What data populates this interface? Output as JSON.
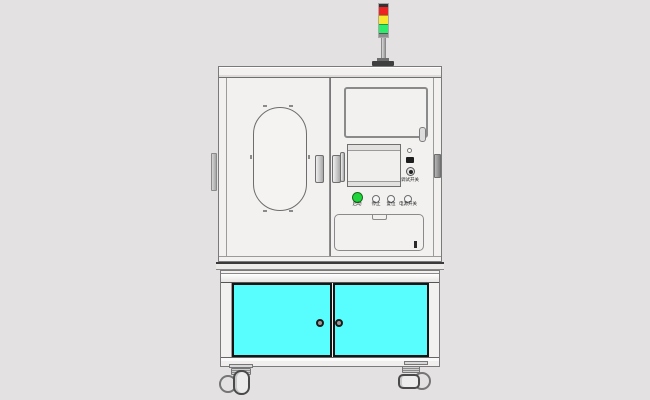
{
  "colors": {
    "background": "#e3e1e1",
    "machine_body": "#f2f1f0",
    "panel_inset": "#eeedec",
    "cabinet_door": "#58fefe",
    "door_border": "#141414",
    "tower_red": "#ee2222",
    "tower_yellow": "#f6e82c",
    "tower_green": "#2cec6a",
    "btn_green": "#1fd53c"
  },
  "tower_light": {
    "segments": [
      "red",
      "yellow",
      "green"
    ]
  },
  "control_panel": {
    "buttons": [
      {
        "label": "启动"
      },
      {
        "label": "停止"
      },
      {
        "label": "复位"
      },
      {
        "label": "电源开关"
      }
    ],
    "key_switch_label": "调试开关"
  }
}
